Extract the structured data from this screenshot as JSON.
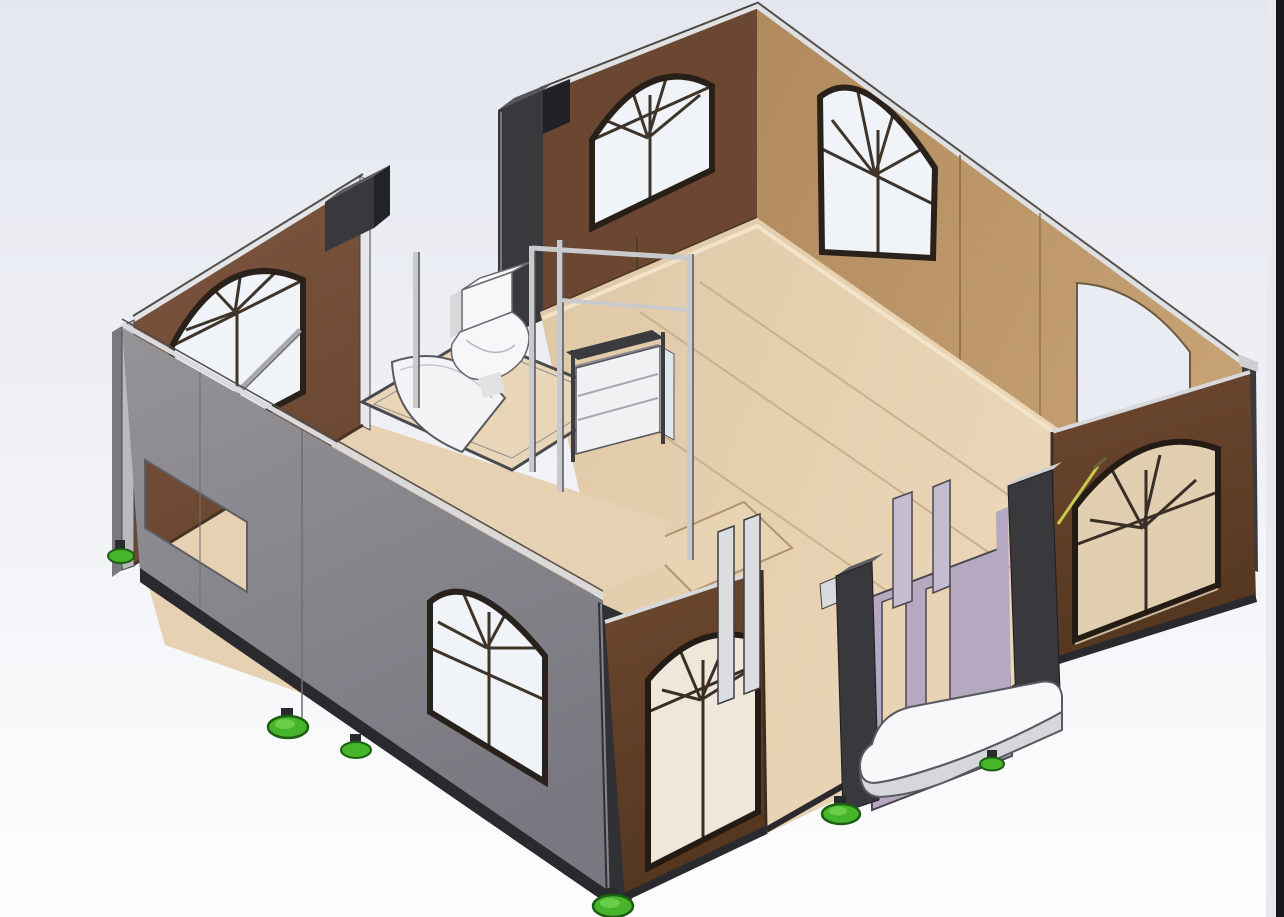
{
  "scene": {
    "type": "3d-cad-render",
    "colors": {
      "background_top": "#e4e7ef",
      "background_mid": "#eef0f5",
      "background_bottom": "#fdfdfe",
      "right_strip": "#17181b",
      "wall_brown_left": "#77513a",
      "wall_brown_dark": "#6b4630",
      "wall_tan": "#b7905f",
      "wall_front_brown": "#66422b",
      "wall_gray": "#8b8a8e",
      "gray_end_cap": "#b9babe",
      "gray_dark_face": "#7a797d",
      "floor_tan": "#e3cdac",
      "floor_left_wing": "#e6d2b3",
      "bath_floor": "#e9d5b7",
      "lavender_panel": "#b4a9c1",
      "lavender_riser": "#c5bccf",
      "post_dark": "#38383d",
      "post_top": "#5c5c63",
      "frame_dark": "#2a211b",
      "pane_white": "#f0f3f7",
      "pane_interior_tan": "#e2ceb0",
      "pane_front_door": "#efe8da",
      "cap_light": "#dfe0e4",
      "seam": "#c9b190",
      "floor_highlight": "#f2e4ca",
      "step_top": "#f7f8f9",
      "step_side": "#d5d7da",
      "green_foot": "#46b52b",
      "green_foot_dark": "#1d5f12",
      "green_foot_light": "#72d353",
      "sky_through_hole": "#e9ecf2",
      "shower_tray": "#f4f4f6",
      "toilet_white": "#f7f7f9",
      "shelf_body": "#f0f1f3",
      "shelf_side_blue": "#dde8ee",
      "stud_light": "#c9cacd",
      "rail_dark": "#2a2a2e",
      "curb_dark": "#4a4a4e",
      "annotation_yellow": "#c9c94c",
      "hatch_fill": "#e8d3b2"
    }
  }
}
